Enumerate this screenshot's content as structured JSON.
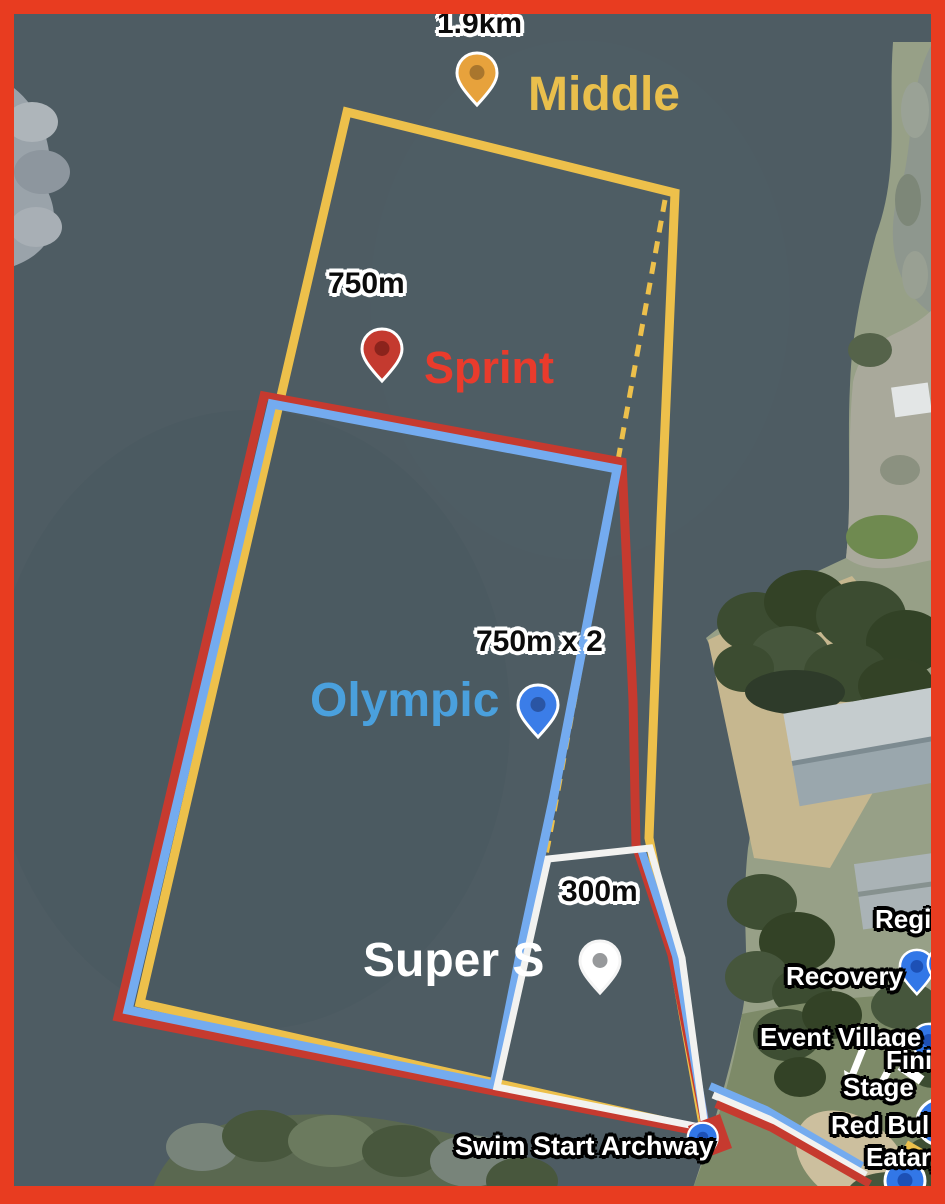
{
  "map": {
    "water_color": "#4e5c63"
  },
  "frame": {
    "border_color": "#e83c20"
  },
  "courses": {
    "middle": {
      "name": "Middle",
      "distance": "1.9km",
      "line_color": "#edc04b",
      "label_color": "#e9bf4c",
      "pin_color": "#e7a23c",
      "pin_dot_color": "#a9762d"
    },
    "sprint": {
      "name": "Sprint",
      "distance": "750m",
      "line_color": "#c63a2f",
      "label_color": "#e93b2c",
      "pin_color": "#c43a2f",
      "pin_dot_color": "#8b231c"
    },
    "olympic": {
      "name": "Olympic",
      "distance": "750m x 2",
      "line_color": "#74abef",
      "label_color": "#4aa0dd",
      "pin_color": "#3b7de8",
      "pin_dot_color": "#2a55a4"
    },
    "super_sprint": {
      "name": "Super S",
      "distance": "300m",
      "line_color": "#f2f2f0",
      "label_color": "#ffffff",
      "pin_color": "#ffffff",
      "pin_dot_color": "#97999b"
    }
  },
  "pois": {
    "pin_color": "#3277e7",
    "pin_dot_color": "#1d50b5",
    "swim_start": {
      "label": "Swim Start Archway"
    },
    "registration": {
      "label": "Regis"
    },
    "recovery": {
      "label": "Recovery"
    },
    "event_village": {
      "label": "Event Village"
    },
    "finish": {
      "label": "Fini"
    },
    "stage": {
      "label": "Stage"
    },
    "red_bull": {
      "label": "Red Bull"
    },
    "eatary": {
      "label": "Eatary"
    }
  }
}
